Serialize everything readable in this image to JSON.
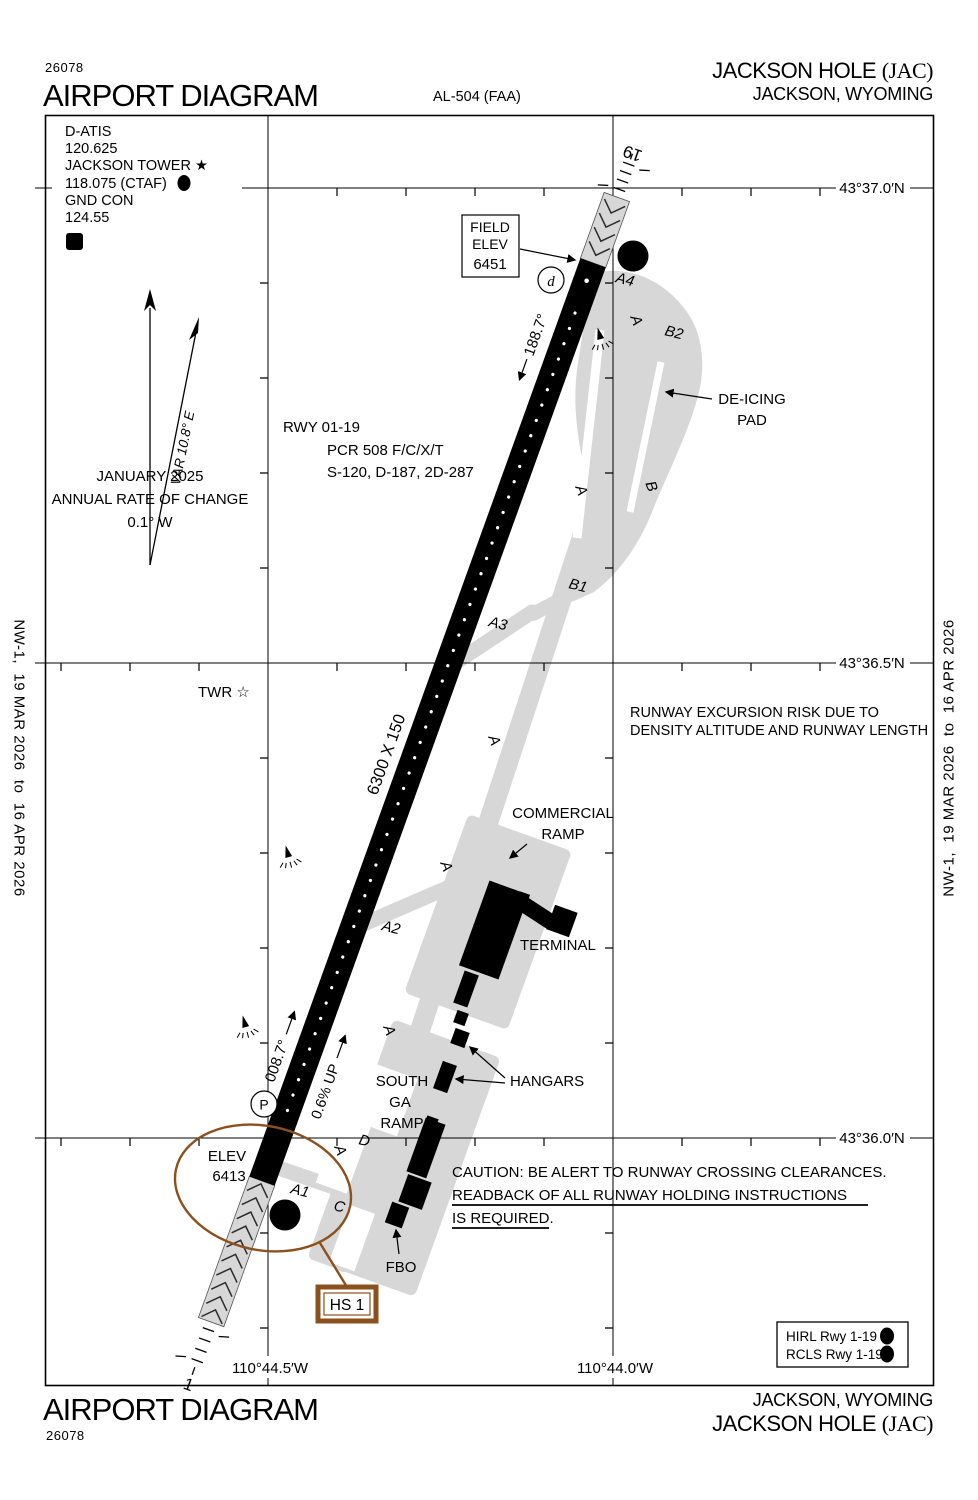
{
  "doc": {
    "chart_number": "26078",
    "title": "AIRPORT DIAGRAM",
    "al_ref": "AL-504 (FAA)",
    "airport_name": "JACKSON HOLE",
    "airport_icao": "(JAC)",
    "city_state": "JACKSON, WYOMING",
    "margin_note": "NW-1,  19 MAR 2026  to  16 APR 2026"
  },
  "comms": {
    "atis_label": "D-ATIS",
    "atis_freq": "120.625",
    "tower_label": "JACKSON TOWER ★",
    "tower_freq": "118.075 (CTAF)",
    "gnd_label": "GND CON",
    "gnd_freq": "124.55",
    "atis_code": "D",
    "lighted_code": "L"
  },
  "field_elev": {
    "label1": "FIELD",
    "label2": "ELEV",
    "value": "6451"
  },
  "south_elev": {
    "label": "ELEV",
    "value": "6413"
  },
  "runway": {
    "id": "RWY 01-19",
    "pcr": "PCR 508 F/C/X/T",
    "strength": "S-120, D-187, 2D-287",
    "dimensions": "6300 X 150",
    "true_heading_19": "188.7°",
    "true_heading_01": "008.7°",
    "gradient": "0.6% UP",
    "end_19": "19",
    "end_01": "1"
  },
  "variation": {
    "label": "VAR 10.8° E",
    "date": "JANUARY 2025",
    "note1": "ANNUAL RATE OF CHANGE",
    "note2": "0.1° W"
  },
  "tower": {
    "label": "TWR ☆"
  },
  "ramps": {
    "deicing1": "DE-ICING",
    "deicing2": "PAD",
    "commercial1": "COMMERCIAL",
    "commercial2": "RAMP",
    "terminal": "TERMINAL",
    "hangars": "HANGARS",
    "south1": "SOUTH",
    "south2": "GA",
    "south3": "RAMP",
    "fbo": "FBO"
  },
  "taxiways": {
    "a": "A",
    "b": "B",
    "a1": "A1",
    "a2": "A2",
    "a3": "A3",
    "a4": "A4",
    "b1": "B1",
    "b2": "B2",
    "c": "C",
    "d": "D"
  },
  "markers": {
    "hold_letter": "A",
    "hold_sub": "4",
    "parking": "P",
    "disp": "d"
  },
  "notes": {
    "excursion1": "RUNWAY EXCURSION RISK DUE TO",
    "excursion2": "DENSITY ALTITUDE AND RUNWAY LENGTH",
    "caution1": "CAUTION: BE ALERT TO RUNWAY CROSSING CLEARANCES.",
    "caution2": "READBACK OF ALL RUNWAY HOLDING INSTRUCTIONS",
    "caution3": "IS REQUIRED."
  },
  "hotspot": {
    "label": "HS 1"
  },
  "lighting": {
    "hirl": "HIRL Rwy 1-19",
    "rcls": "RCLS Rwy 1-19",
    "code": "L"
  },
  "coords": {
    "lat1": "43°37.0′N",
    "lat2": "43°36.5′N",
    "lat3": "43°36.0′N",
    "lon1": "110°44.5′W",
    "lon2": "110°44.0′W"
  },
  "colors": {
    "hotspot": "#8C501C",
    "taxiway": "#D7D7D7"
  }
}
